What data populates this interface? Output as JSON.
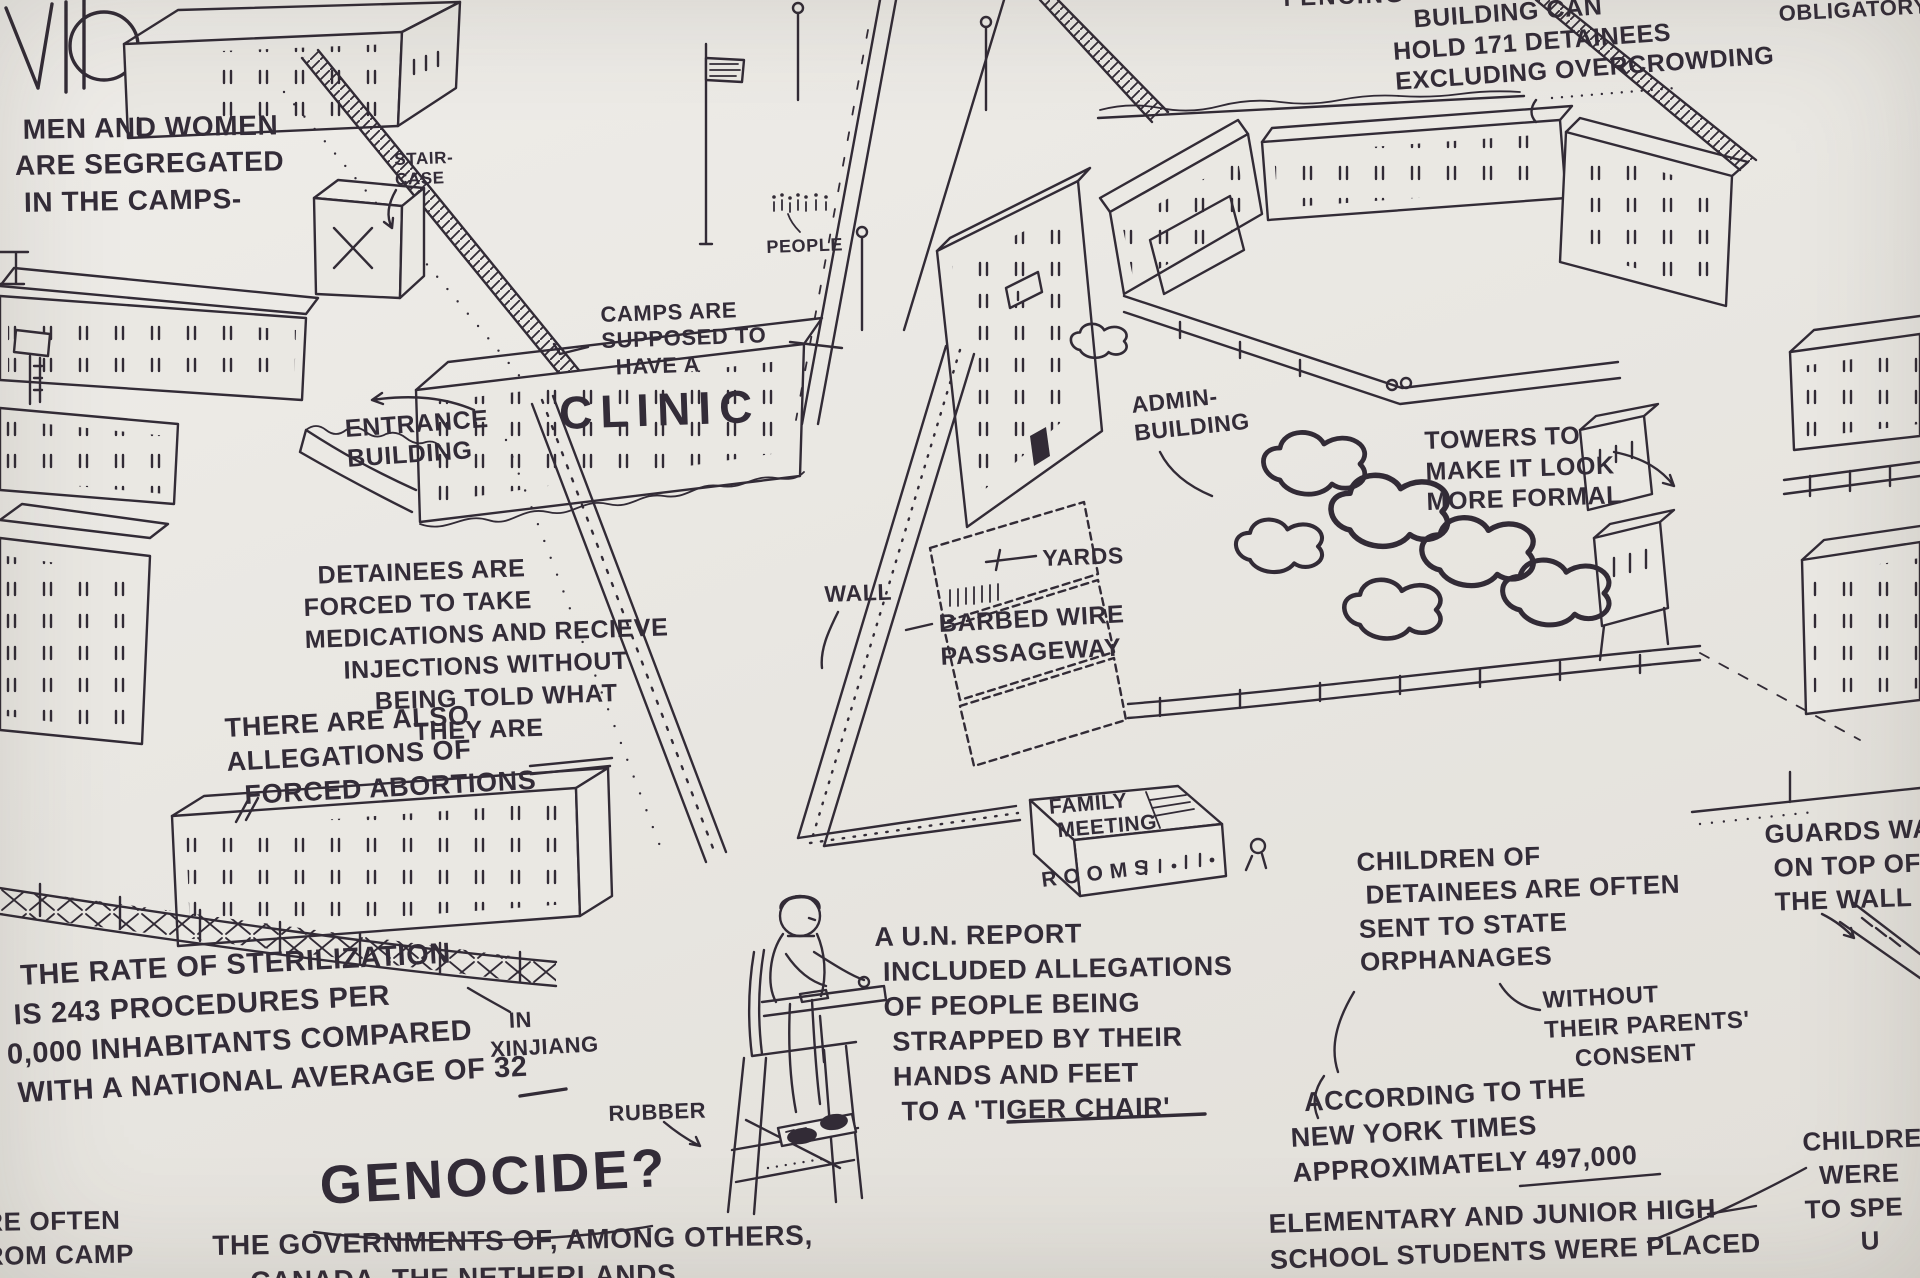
{
  "palette": {
    "paper": "#e9e7e2",
    "ink": "#322b36"
  },
  "annotations": {
    "fencing": {
      "text": "FENCING",
      "x": 1283,
      "y": -16,
      "size": 24,
      "rot": -2,
      "ls": 2
    },
    "capacity": {
      "text": "   BUILDING CAN\nHOLD 171 DETAINEES\nEXCLUDING OVERCROWDING",
      "x": 1390,
      "y": 6,
      "size": 25,
      "rot": -4,
      "lh": 1.22
    },
    "obligatory": {
      "text": "OBLIGATORY",
      "x": 1778,
      "y": 0,
      "size": 22,
      "rot": -3
    },
    "segregated": {
      "text": " MEN AND WOMEN\nARE SEGREGATED\n IN THE CAMPS-",
      "x": 14,
      "y": 112,
      "size": 28,
      "rot": -1,
      "lh": 1.3
    },
    "staircase": {
      "text": "STAIR-\nCASE",
      "x": 394,
      "y": 150,
      "size": 17,
      "rot": -2,
      "lh": 1.15
    },
    "people": {
      "text": "PEOPLE",
      "x": 766,
      "y": 236,
      "size": 18,
      "rot": -2
    },
    "clinic_note": {
      "text": "CAMPS ARE\nSUPPOSED TO\n  HAVE A",
      "x": 600,
      "y": 302,
      "size": 22,
      "rot": -2,
      "lh": 1.2
    },
    "clinic_word": {
      "text": "CLINIC",
      "x": 558,
      "y": 384,
      "size": 46,
      "rot": -2,
      "ls": 8
    },
    "entrance": {
      "text": "ENTRANCE\nBUILDING",
      "x": 344,
      "y": 414,
      "size": 25,
      "rot": -4,
      "lh": 1.2
    },
    "admin": {
      "text": "ADMIN-\nBUILDING",
      "x": 1130,
      "y": 392,
      "size": 23,
      "rot": -6,
      "lh": 1.2
    },
    "towers": {
      "text": "TOWERS TO\nMAKE IT LOOK\nMORE FORMAL",
      "x": 1424,
      "y": 426,
      "size": 25,
      "rot": -2,
      "lh": 1.22
    },
    "yards": {
      "text": "YARDS",
      "x": 1042,
      "y": 544,
      "size": 23,
      "rot": -2
    },
    "wall": {
      "text": "WALL",
      "x": 824,
      "y": 580,
      "size": 23,
      "rot": -2
    },
    "barbed": {
      "text": "BARBED WIRE\nPASSAGEWAY",
      "x": 938,
      "y": 608,
      "size": 25,
      "rot": -3,
      "lh": 1.3
    },
    "medications": {
      "text": "  DETAINEES ARE\nFORCED TO TAKE\nMEDICATIONS AND RECIEVE\n     INJECTIONS WITHOUT\n         BEING TOLD WHAT\n              THEY ARE",
      "x": 302,
      "y": 560,
      "size": 25,
      "rot": -2,
      "lh": 1.28
    },
    "abortions": {
      "text": "THERE ARE ALSO\nALLEGATIONS OF\n  FORCED ABORTIONS",
      "x": 224,
      "y": 712,
      "size": 27,
      "rot": -3,
      "lh": 1.25
    },
    "family_meeting": {
      "text": "FAMILY\n MEETING",
      "x": 1048,
      "y": 796,
      "size": 21,
      "rot": -5,
      "lh": 1.15
    },
    "rooms": {
      "text": "ROOMS",
      "x": 1040,
      "y": 868,
      "size": 21,
      "rot": -7,
      "ls": 7
    },
    "sterilization": {
      "text": "  THE RATE OF STERILIZATION\n IS 243 PROCEDURES PER\n0,000 INHABITANTS COMPARED\n WITH A NATIONAL AVERAGE OF 32",
      "x": 2,
      "y": 958,
      "size": 29,
      "rot": -3,
      "lh": 1.35
    },
    "xinjiang": {
      "text": "   IN\nXINJIANG",
      "x": 488,
      "y": 1008,
      "size": 22,
      "rot": -3,
      "lh": 1.25
    },
    "rubber": {
      "text": "RUBBER",
      "x": 608,
      "y": 1100,
      "size": 22,
      "rot": -2
    },
    "un_report": {
      "text": "A U.N. REPORT\n INCLUDED ALLEGATIONS\n OF PEOPLE BEING\n  STRAPPED BY THEIR\n  HANDS AND FEET\n   TO A 'TIGER CHAIR'",
      "x": 874,
      "y": 920,
      "size": 27,
      "rot": -1,
      "lh": 1.3
    },
    "orphanages": {
      "text": "CHILDREN OF\n DETAINEES ARE OFTEN\nSENT TO STATE\nORPHANAGES",
      "x": 1356,
      "y": 846,
      "size": 26,
      "rot": -2,
      "lh": 1.28
    },
    "consent": {
      "text": "WITHOUT\nTHEIR PARENTS'\n    CONSENT",
      "x": 1542,
      "y": 986,
      "size": 24,
      "rot": -3,
      "lh": 1.25
    },
    "nyt": {
      "text": "  ACCORDING TO THE\nNEW YORK TIMES\nAPPROXIMATELY 497,000",
      "x": 1288,
      "y": 1086,
      "size": 27,
      "rot": -3,
      "lh": 1.3
    },
    "elementary": {
      "text": "ELEMENTARY AND JUNIOR HIGH\nSCHOOL STUDENTS WERE PLACED",
      "x": 1268,
      "y": 1206,
      "size": 27,
      "rot": -2,
      "lh": 1.35
    },
    "guards": {
      "text": "GUARDS WALK\n ON TOP OF\n THE WALL",
      "x": 1764,
      "y": 818,
      "size": 26,
      "rot": -2,
      "lh": 1.3
    },
    "children_partial": {
      "text": " CHILDREN\n   WERE\n TO SPE\n        U",
      "x": 1794,
      "y": 1126,
      "size": 26,
      "rot": -2,
      "lh": 1.3
    },
    "corner_partial": {
      "text": "RE OFTEN\nROM CAMP",
      "x": -16,
      "y": 1206,
      "size": 26,
      "rot": -1,
      "lh": 1.3
    },
    "genocide": {
      "text": "GENOCIDE?",
      "x": 318,
      "y": 1152,
      "size": 54,
      "rot": -3,
      "ls": 3
    },
    "governments": {
      "text": "THE GOVERNMENTS OF, AMONG OTHERS,",
      "x": 212,
      "y": 1228,
      "size": 28,
      "rot": -1
    },
    "canada_partial": {
      "text": "CANADA, THE NETHERLANDS",
      "x": 250,
      "y": 1264,
      "size": 28,
      "rot": -1
    }
  }
}
